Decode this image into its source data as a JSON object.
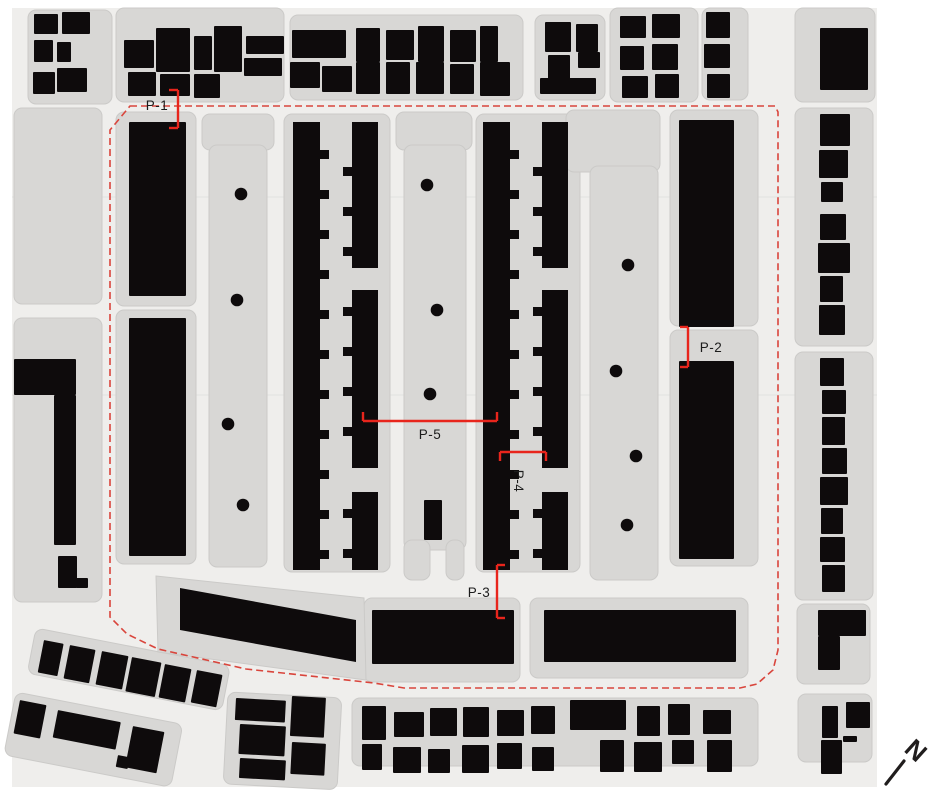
{
  "title": "Figure-ground site plan with survey points P-1 to P-5",
  "colors": {
    "background": "#ffffff",
    "map_bg": "#efeeec",
    "parcel": "#d8d7d5",
    "parcel_edge": "#cbcac8",
    "building": "#0e0b0c",
    "boundary_red": "#d9453c",
    "marker_red": "#e8251c",
    "label_text": "#1c1c1c",
    "north": "#201d1d",
    "gridline": "rgba(0,0,0,0.05)"
  },
  "map": {
    "width": 933,
    "height": 793,
    "bg_rect": [
      12,
      8,
      865,
      779
    ],
    "gridlines_y": [
      197,
      395
    ],
    "parcels": [
      [
        28,
        10,
        84,
        94
      ],
      [
        116,
        8,
        168,
        94
      ],
      [
        290,
        15,
        233,
        85
      ],
      [
        535,
        15,
        70,
        85
      ],
      [
        610,
        8,
        88,
        94
      ],
      [
        702,
        8,
        46,
        92
      ],
      [
        795,
        8,
        80,
        94
      ],
      [
        795,
        108,
        78,
        238
      ],
      [
        795,
        352,
        78,
        248
      ],
      [
        797,
        604,
        73,
        80
      ],
      [
        14,
        108,
        88,
        196
      ],
      [
        14,
        318,
        88,
        284
      ],
      [
        116,
        112,
        80,
        194
      ],
      [
        116,
        310,
        80,
        254
      ],
      [
        202,
        114,
        72,
        36
      ],
      [
        209,
        145,
        58,
        422
      ],
      [
        284,
        114,
        106,
        458
      ],
      [
        396,
        112,
        76,
        38
      ],
      [
        404,
        145,
        62,
        405
      ],
      [
        404,
        540,
        26,
        40
      ],
      [
        446,
        540,
        18,
        40
      ],
      [
        476,
        114,
        104,
        458
      ],
      [
        566,
        110,
        94,
        62
      ],
      [
        590,
        166,
        68,
        414
      ],
      [
        670,
        110,
        88,
        216
      ],
      [
        670,
        330,
        88,
        236
      ],
      [
        364,
        598,
        156,
        84
      ],
      [
        530,
        598,
        218,
        80
      ],
      [
        352,
        698,
        406,
        68
      ],
      [
        798,
        694,
        74,
        68
      ],
      [
        36,
        628,
        198,
        46,
        11
      ],
      [
        16,
        692,
        170,
        64,
        11
      ],
      [
        228,
        692,
        114,
        92,
        3
      ]
    ],
    "parcels_poly": [
      [
        [
          156,
          576
        ],
        [
          364,
          598
        ],
        [
          366,
          680
        ],
        [
          158,
          652
        ]
      ]
    ],
    "buildings": [
      [
        34,
        14,
        24,
        20
      ],
      [
        62,
        12,
        28,
        22
      ],
      [
        34,
        40,
        19,
        22
      ],
      [
        57,
        42,
        14,
        20
      ],
      [
        33,
        72,
        22,
        22
      ],
      [
        57,
        68,
        30,
        24
      ],
      [
        124,
        40,
        30,
        28
      ],
      [
        156,
        28,
        34,
        44
      ],
      [
        194,
        36,
        18,
        34
      ],
      [
        214,
        26,
        28,
        46
      ],
      [
        246,
        36,
        38,
        18
      ],
      [
        128,
        72,
        28,
        24
      ],
      [
        160,
        74,
        30,
        22
      ],
      [
        194,
        74,
        26,
        24
      ],
      [
        244,
        58,
        38,
        18
      ],
      [
        292,
        30,
        54,
        28
      ],
      [
        356,
        28,
        24,
        34
      ],
      [
        386,
        30,
        28,
        30
      ],
      [
        418,
        26,
        26,
        36
      ],
      [
        450,
        30,
        26,
        32
      ],
      [
        480,
        26,
        18,
        36
      ],
      [
        290,
        62,
        30,
        26
      ],
      [
        322,
        66,
        30,
        26
      ],
      [
        356,
        62,
        24,
        32
      ],
      [
        386,
        62,
        24,
        32
      ],
      [
        416,
        62,
        28,
        32
      ],
      [
        450,
        64,
        24,
        30
      ],
      [
        480,
        62,
        30,
        34
      ],
      [
        545,
        22,
        26,
        30
      ],
      [
        576,
        24,
        22,
        28
      ],
      [
        548,
        55,
        22,
        24
      ],
      [
        578,
        52,
        22,
        16
      ],
      [
        540,
        78,
        56,
        16
      ],
      [
        620,
        16,
        26,
        22
      ],
      [
        652,
        14,
        28,
        24
      ],
      [
        620,
        46,
        24,
        24
      ],
      [
        652,
        44,
        26,
        26
      ],
      [
        622,
        76,
        26,
        22
      ],
      [
        655,
        74,
        24,
        24
      ],
      [
        706,
        12,
        24,
        26
      ],
      [
        704,
        44,
        26,
        24
      ],
      [
        707,
        74,
        23,
        24
      ],
      [
        820,
        28,
        48,
        62
      ],
      [
        820,
        114,
        30,
        32
      ],
      [
        819,
        150,
        29,
        28
      ],
      [
        821,
        182,
        22,
        20
      ],
      [
        820,
        214,
        26,
        26
      ],
      [
        818,
        243,
        32,
        30
      ],
      [
        820,
        276,
        23,
        26
      ],
      [
        819,
        305,
        26,
        30
      ],
      [
        820,
        358,
        24,
        28
      ],
      [
        822,
        390,
        24,
        24
      ],
      [
        822,
        417,
        23,
        28
      ],
      [
        822,
        448,
        25,
        26
      ],
      [
        820,
        477,
        28,
        28
      ],
      [
        821,
        508,
        22,
        26
      ],
      [
        820,
        537,
        25,
        25
      ],
      [
        822,
        565,
        23,
        27
      ],
      [
        818,
        610,
        48,
        26
      ],
      [
        818,
        636,
        22,
        34
      ],
      [
        14,
        359,
        62,
        36
      ],
      [
        54,
        395,
        22,
        150
      ],
      [
        58,
        556,
        19,
        32
      ],
      [
        76,
        578,
        12,
        10
      ],
      [
        129,
        122,
        57,
        174
      ],
      [
        129,
        318,
        57,
        238
      ],
      [
        679,
        120,
        55,
        207
      ],
      [
        679,
        361,
        55,
        198
      ],
      [
        424,
        500,
        18,
        40
      ],
      [
        372,
        610,
        142,
        54
      ],
      [
        544,
        610,
        192,
        52
      ],
      [
        236,
        698,
        50,
        22,
        3
      ],
      [
        292,
        696,
        34,
        40,
        3
      ],
      [
        240,
        724,
        46,
        30,
        3
      ],
      [
        292,
        742,
        34,
        32,
        3
      ],
      [
        240,
        758,
        46,
        20,
        3
      ],
      [
        362,
        706,
        24,
        34
      ],
      [
        394,
        712,
        30,
        25
      ],
      [
        430,
        708,
        27,
        28
      ],
      [
        463,
        707,
        26,
        30
      ],
      [
        497,
        710,
        27,
        26
      ],
      [
        531,
        706,
        24,
        28
      ],
      [
        570,
        700,
        56,
        30
      ],
      [
        637,
        706,
        23,
        30
      ],
      [
        668,
        704,
        22,
        31
      ],
      [
        703,
        710,
        28,
        24
      ],
      [
        362,
        744,
        20,
        26
      ],
      [
        393,
        747,
        28,
        26
      ],
      [
        428,
        749,
        22,
        24
      ],
      [
        462,
        745,
        27,
        28
      ],
      [
        497,
        743,
        25,
        26
      ],
      [
        532,
        747,
        22,
        24
      ],
      [
        600,
        740,
        24,
        32
      ],
      [
        634,
        742,
        28,
        30
      ],
      [
        672,
        740,
        22,
        24
      ],
      [
        707,
        740,
        25,
        32
      ],
      [
        822,
        706,
        16,
        32
      ],
      [
        846,
        702,
        24,
        26
      ],
      [
        843,
        736,
        14,
        6
      ],
      [
        821,
        740,
        21,
        34
      ],
      [
        44,
        640,
        20,
        33,
        11
      ],
      [
        70,
        645,
        26,
        34,
        11
      ],
      [
        102,
        651,
        27,
        34,
        11
      ],
      [
        132,
        657,
        30,
        35,
        11
      ],
      [
        165,
        664,
        27,
        34,
        11
      ],
      [
        197,
        670,
        26,
        33,
        11
      ],
      [
        20,
        700,
        27,
        34,
        11
      ],
      [
        58,
        710,
        64,
        28,
        11
      ],
      [
        133,
        726,
        32,
        42,
        11
      ],
      [
        118,
        755,
        12,
        12,
        11
      ]
    ],
    "buildings_poly": [
      [
        [
          180,
          588
        ],
        [
          356,
          620
        ],
        [
          356,
          662
        ],
        [
          180,
          630
        ]
      ]
    ],
    "combs": [
      {
        "slab": [
          293,
          122,
          27,
          448
        ],
        "tooth_x": 320,
        "tooth_ys": [
          150,
          190,
          230,
          270,
          310,
          350,
          390,
          430,
          470,
          510,
          550
        ]
      },
      {
        "slab": [
          352,
          122,
          26,
          146
        ],
        "tooth_x": 343,
        "tooth_ys": [
          167,
          207,
          247
        ]
      },
      {
        "slab": [
          352,
          290,
          26,
          178
        ],
        "tooth_x": 343,
        "tooth_ys": [
          307,
          347,
          387,
          427
        ]
      },
      {
        "slab": [
          352,
          492,
          26,
          78
        ],
        "tooth_x": 343,
        "tooth_ys": [
          509,
          549
        ]
      },
      {
        "slab": [
          483,
          122,
          27,
          448
        ],
        "tooth_x": 510,
        "tooth_ys": [
          150,
          190,
          230,
          270,
          310,
          350,
          390,
          430,
          470,
          510,
          550
        ]
      },
      {
        "slab": [
          542,
          122,
          26,
          146
        ],
        "tooth_x": 533,
        "tooth_ys": [
          167,
          207,
          247
        ]
      },
      {
        "slab": [
          542,
          290,
          26,
          178
        ],
        "tooth_x": 533,
        "tooth_ys": [
          307,
          347,
          387,
          427
        ]
      },
      {
        "slab": [
          542,
          492,
          26,
          78
        ],
        "tooth_x": 533,
        "tooth_ys": [
          509,
          549
        ]
      }
    ],
    "tooth_size": [
      9,
      9
    ],
    "trees": [
      [
        241,
        194
      ],
      [
        237,
        300
      ],
      [
        228,
        424
      ],
      [
        243,
        505
      ],
      [
        427,
        185
      ],
      [
        437,
        310
      ],
      [
        430,
        394
      ],
      [
        628,
        265
      ],
      [
        616,
        371
      ],
      [
        636,
        456
      ],
      [
        627,
        525
      ]
    ],
    "tree_radius": 6.3,
    "boundary": {
      "points": [
        [
          130,
          106
        ],
        [
          775,
          106
        ],
        [
          778,
          112
        ],
        [
          778,
          650
        ],
        [
          773,
          670
        ],
        [
          757,
          684
        ],
        [
          740,
          688
        ],
        [
          404,
          688
        ],
        [
          374,
          683
        ],
        [
          246,
          669
        ],
        [
          158,
          649
        ],
        [
          127,
          634
        ],
        [
          110,
          617
        ],
        [
          110,
          130
        ]
      ],
      "dash": "7 4",
      "width": 1.6
    },
    "markers": [
      {
        "id": "p-1",
        "label": "P-1",
        "segments": [
          [
            178,
            90,
            178,
            128
          ],
          [
            169,
            90,
            178,
            90
          ],
          [
            169,
            128,
            178,
            128
          ]
        ],
        "label_x": 157,
        "label_y": 110,
        "rotate": 0
      },
      {
        "id": "p-2",
        "label": "P-2",
        "segments": [
          [
            688,
            327,
            688,
            367
          ],
          [
            680,
            327,
            688,
            327
          ],
          [
            680,
            367,
            688,
            367
          ]
        ],
        "label_x": 711,
        "label_y": 352,
        "rotate": 0
      },
      {
        "id": "p-3",
        "label": "P-3",
        "segments": [
          [
            497,
            565,
            497,
            618
          ],
          [
            497,
            565,
            505,
            565
          ],
          [
            497,
            618,
            505,
            618
          ]
        ],
        "label_x": 479,
        "label_y": 597,
        "rotate": 0
      },
      {
        "id": "p-4",
        "label": "P-4",
        "segments": [
          [
            500,
            452,
            546,
            452
          ],
          [
            500,
            452,
            500,
            461
          ],
          [
            546,
            452,
            546,
            461
          ]
        ],
        "label_x": 514,
        "label_y": 481,
        "rotate": 90
      },
      {
        "id": "p-5",
        "label": "P-5",
        "segments": [
          [
            363,
            421,
            497,
            421
          ],
          [
            363,
            412,
            363,
            421
          ],
          [
            497,
            412,
            497,
            421
          ]
        ],
        "label_x": 430,
        "label_y": 439,
        "rotate": 0
      }
    ],
    "marker_stroke": 2.4,
    "north_arrow": {
      "label": "N",
      "line": [
        886,
        784,
        904,
        761
      ],
      "line_width": 3.2,
      "label_x": 910,
      "label_y": 757,
      "rotate": 42
    }
  }
}
